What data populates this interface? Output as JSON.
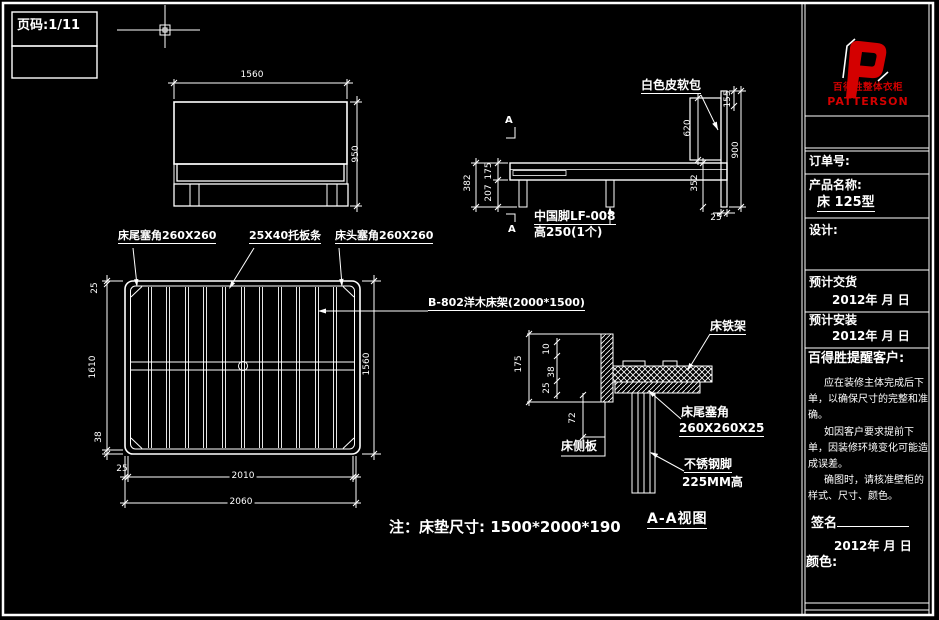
{
  "sheet": {
    "bg": "#000000",
    "line": "#ffffff",
    "accent_red": "#d40000"
  },
  "page_label": "页码:1/11",
  "front_view": {
    "dim_width": "1560",
    "dim_height": "950"
  },
  "side_view": {
    "label_softpack": "白色皮软包",
    "section_a_top": "A",
    "section_a_bottom": "A",
    "label_leg_line1": "中国脚LF-008",
    "label_leg_line2": "高250(1个)",
    "dim_382": "382",
    "dim_175": "175",
    "dim_207": "207",
    "dim_620": "620",
    "dim_155": "155",
    "dim_900": "900",
    "dim_352": "352",
    "dim_25": "25"
  },
  "plan_view": {
    "label_corner_tail": "床尾塞角260X260",
    "label_slats": "25X40托板条",
    "label_corner_head": "床头塞角260X260",
    "label_frame": "B-802洋木床架(2000*1500)",
    "dim_left_25": "25",
    "dim_1610": "1610",
    "dim_38": "38",
    "dim_1560": "1560",
    "dim_bottom_25": "25",
    "dim_2010": "2010",
    "dim_2060": "2060"
  },
  "section_view": {
    "title": "A-A视图",
    "label_iron_frame": "床铁架",
    "label_corner_line1": "床尾塞角",
    "label_corner_line2": "260X260X25",
    "label_side_board": "床侧板",
    "label_steel_leg_line1": "不锈钢脚",
    "label_steel_leg_line2": "225MM高",
    "dim_175": "175",
    "dim_10": "10",
    "dim_38": "38",
    "dim_25": "25",
    "dim_72": "72"
  },
  "note": "注：床垫尺寸: 1500*2000*190",
  "title_block": {
    "brand_cn": "百得胜整体衣柜",
    "brand_en": "PATTERSON",
    "order_label": "订单号:",
    "product_label": "产品名称:",
    "product_value": "床 125型",
    "design_label": "设计:",
    "delivery_label": "预计交货",
    "delivery_date": "2012年 月 日",
    "install_label": "预计安装",
    "install_date": "2012年 月 日",
    "notice_title": "百得胜提醒客户:",
    "notice_p1": "应在装修主体完成后下单，以确保尺寸的完整和准确。",
    "notice_p2": "如因客户要求提前下单，因装修环境变化可能造成误差。",
    "notice_p3": "确图时，请核准壁柜的样式、尺寸、颜色。",
    "sign_label": "签名",
    "sign_date": "2012年 月 日",
    "color_label": "颜色:"
  }
}
